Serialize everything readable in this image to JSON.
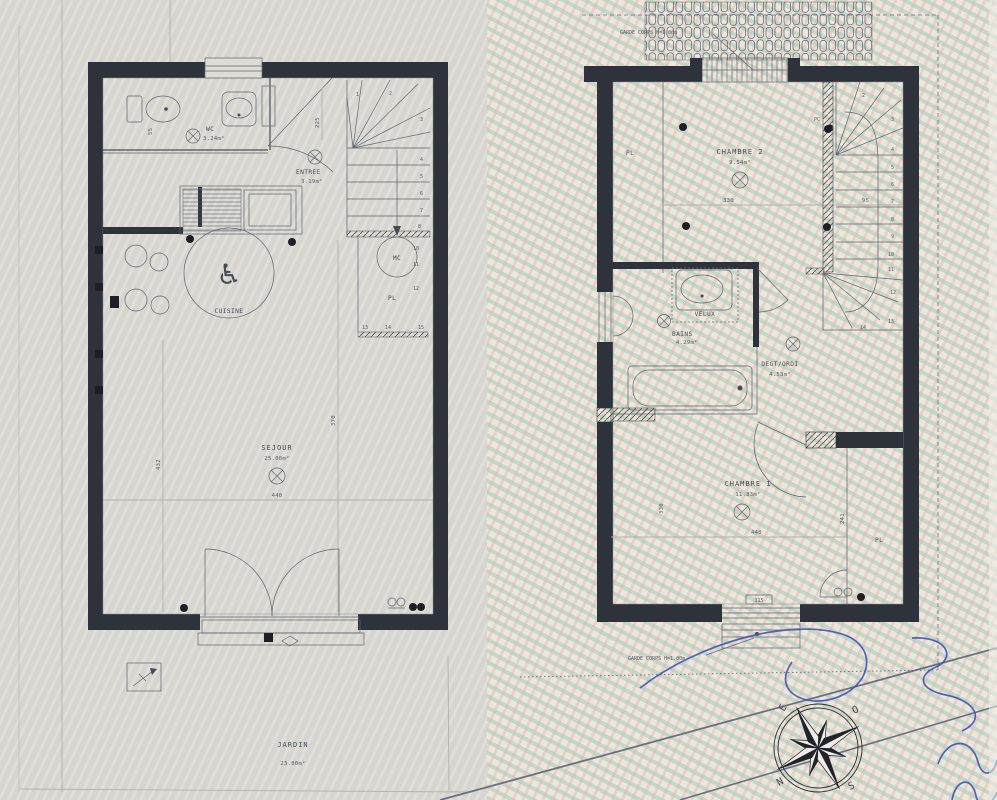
{
  "document": {
    "type": "architectural floor plan, two levels, hand-scanned"
  },
  "colors": {
    "wall": "#2e323b",
    "paper_left": "#d9d8d2",
    "paper_right": "#ece6dc",
    "moire_green": "#84ceb2",
    "moire_pink": "#ecadad",
    "ink": "#474b54",
    "pen_blue": "#3f57b5"
  },
  "ground_floor": {
    "wc": {
      "name": "WC",
      "area": "3.24m²"
    },
    "entree": {
      "name": "ENTREE",
      "area": "3.19m²"
    },
    "cuisine": {
      "name": "CUISINE"
    },
    "sejour": {
      "name": "SEJOUR",
      "area": "25.00m²"
    },
    "jardin": {
      "name": "JARDIN",
      "area": "23.00m²"
    },
    "mc": "MC",
    "pl": "PL",
    "wheelchair": "♿",
    "dims": {
      "d55": "55",
      "d225": "225",
      "d370": "370",
      "d432": "432",
      "d440": "440"
    },
    "stairs": {
      "s1": "1",
      "s2": "2",
      "s3": "3",
      "s4": "4",
      "s5": "5",
      "s6": "6",
      "s7": "7",
      "s8": "8",
      "s10": "10",
      "s11": "11",
      "s12": "12",
      "s13": "13",
      "s14": "14",
      "s15": "15"
    }
  },
  "upper_floor": {
    "chambre2": {
      "name": "CHAMBRE 2",
      "area": "9.54m²"
    },
    "chambre1": {
      "name": "CHAMBRE 1",
      "area": "11.83m²"
    },
    "bains": {
      "name": "BAINS",
      "area": "4.29m²"
    },
    "degt": {
      "name": "DEGT/ORDI",
      "area": "4.53m²"
    },
    "velux": "VELUX",
    "pl_top": "PL",
    "pl_bottom": "PL",
    "pc": "PC",
    "garde_corps_top": "GARDE CORPS H=1.00m",
    "garde_corps_bottom": "GARDE CORPS H=1.00m",
    "window_tag": "115",
    "dims": {
      "d330": "330",
      "d95": "95",
      "d440": "440",
      "d330v": "330",
      "d241": "241"
    },
    "stairs": {
      "s2": "2",
      "s3": "3",
      "s4": "4",
      "s5": "5",
      "s6": "6",
      "s7": "7",
      "s8": "8",
      "s9": "9",
      "s10": "10",
      "s11": "11",
      "s12": "12",
      "s13": "13",
      "s14": "14"
    }
  },
  "compass": {
    "n": "N",
    "e": "E",
    "s": "S",
    "o": "O"
  }
}
